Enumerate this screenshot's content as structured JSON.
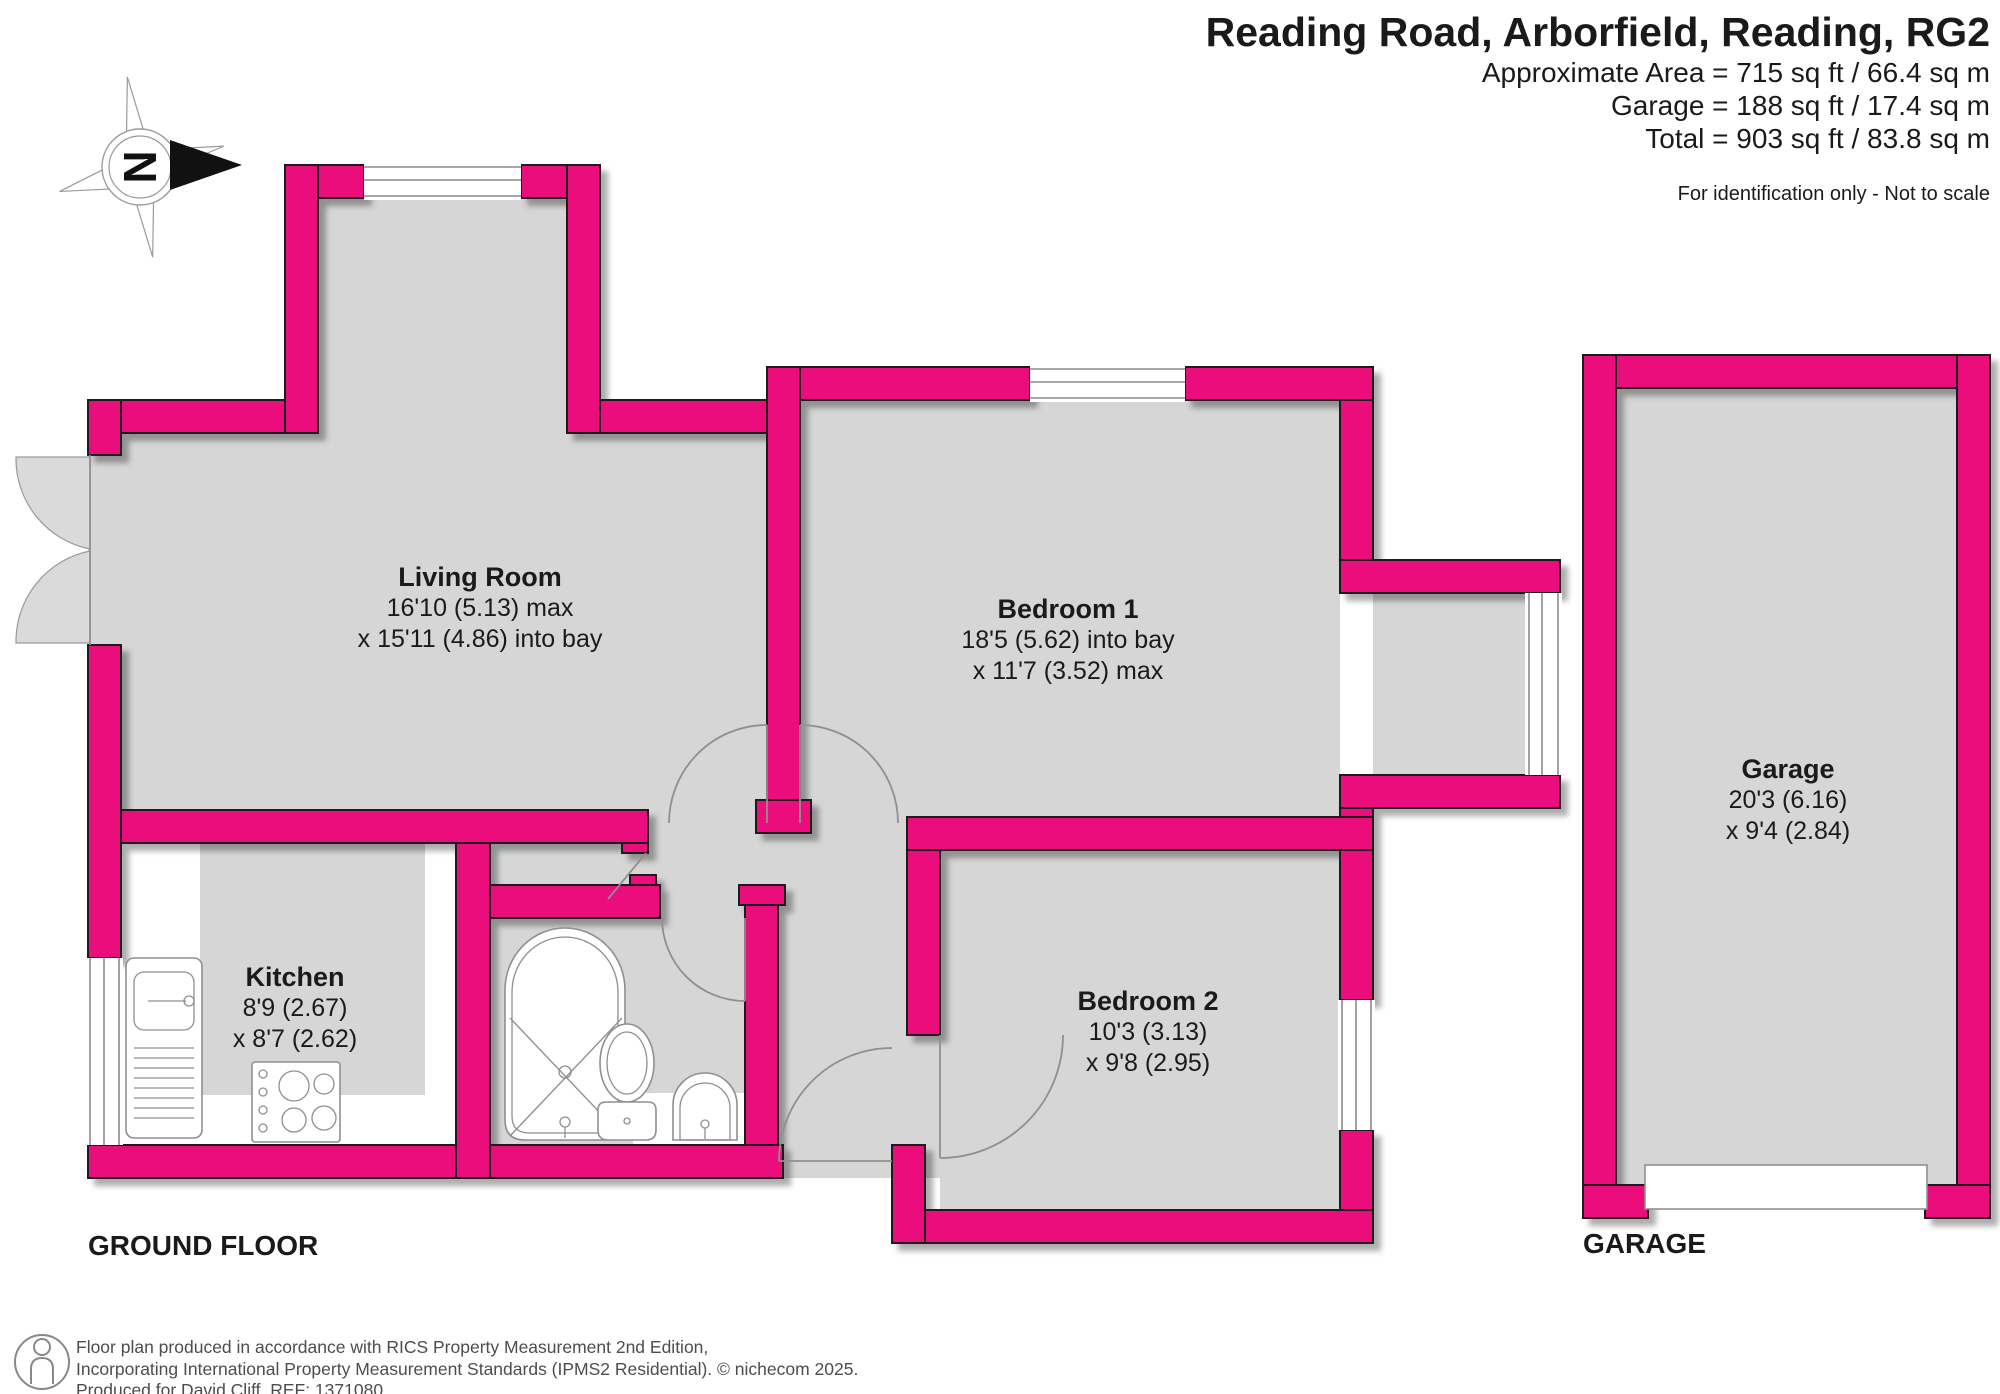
{
  "header": {
    "title": "Reading Road, Arborfield, Reading, RG2",
    "area_line1": "Approximate Area = 715 sq ft / 66.4 sq m",
    "area_line2": "Garage = 188 sq ft / 17.4 sq m",
    "area_line3": "Total = 903 sq ft / 83.8 sq m",
    "disclaimer": "For identification only - Not to scale"
  },
  "compass": {
    "letter": "N"
  },
  "rooms": {
    "living": {
      "name": "Living Room",
      "dim1": "16'10 (5.13) max",
      "dim2": "x 15'11 (4.86) into bay"
    },
    "bedroom1": {
      "name": "Bedroom 1",
      "dim1": "18'5 (5.62) into bay",
      "dim2": "x 11'7 (3.52) max"
    },
    "bedroom2": {
      "name": "Bedroom 2",
      "dim1": "10'3 (3.13)",
      "dim2": "x 9'8 (2.95)"
    },
    "kitchen": {
      "name": "Kitchen",
      "dim1": "8'9 (2.67)",
      "dim2": "x 8'7 (2.62)"
    },
    "garage": {
      "name": "Garage",
      "dim1": "20'3 (6.16)",
      "dim2": "x 9'4 (2.84)"
    }
  },
  "floor_labels": {
    "ground_floor": "GROUND FLOOR",
    "garage": "GARAGE"
  },
  "footer": {
    "line1": "Floor plan produced in accordance with RICS Property Measurement 2nd Edition,",
    "line2": "Incorporating International Property Measurement Standards (IPMS2 Residential).   © nichecom 2025.",
    "line3": "Produced for David Cliff.   REF:  1371080"
  },
  "colors": {
    "wall_pink": "#EC0F7B",
    "floor_gray": "#D6D6D6"
  }
}
